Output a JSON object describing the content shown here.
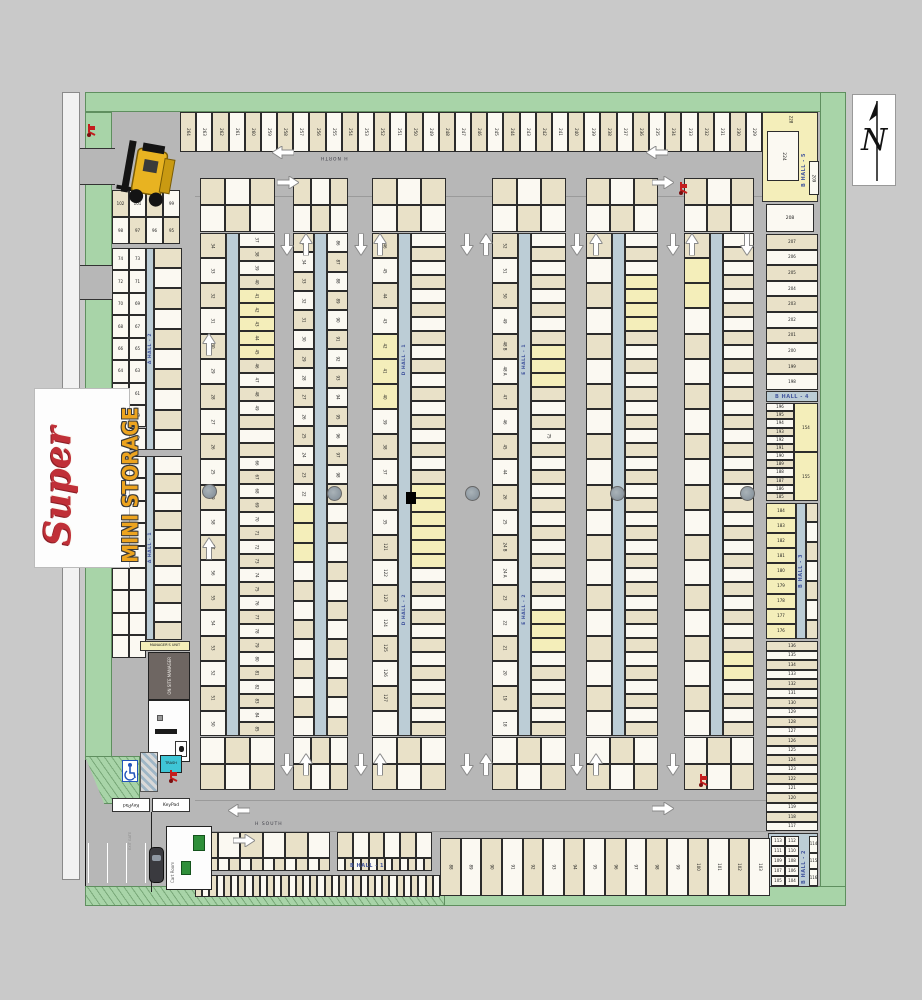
{
  "logo": {
    "super": "Super",
    "mini_storage": "MINI STORAGE"
  },
  "compass": {
    "letter": "N"
  },
  "roads": {
    "north": "H NORTH",
    "south": "H SOUTH"
  },
  "halls": {
    "a1": "A HALL - 1",
    "a2": "A HALL - 2",
    "b1": "B HALL - 1",
    "b2": "B HALL - 2",
    "b3": "B HALL - 3",
    "b4": "B HALL - 4",
    "b5": "B HALL - 5",
    "d1": "D HALL - 1",
    "d2": "D HALL - 2",
    "e1": "E HALL - 1",
    "e2": "E HALL - 2"
  },
  "top_row": {
    "units": [
      "264",
      "263",
      "262",
      "261",
      "260",
      "259",
      "258",
      "257",
      "256",
      "255",
      "254",
      "253",
      "252",
      "251",
      "250",
      "249",
      "248",
      "247",
      "246",
      "245",
      "244",
      "243",
      "242",
      "241",
      "240",
      "239",
      "238",
      "237",
      "236",
      "235",
      "234",
      "233",
      "232",
      "231",
      "230",
      "229"
    ]
  },
  "corner_ne": {
    "u228": "228",
    "u224": "224",
    "u209": "209"
  },
  "right_col": {
    "unit208": "208",
    "col": [
      "207",
      "206",
      "205",
      "204",
      "203",
      "202",
      "201",
      "200",
      "199",
      "198"
    ],
    "hall4_left": [
      "196",
      "195",
      "194",
      "193",
      "192",
      "191",
      "190",
      "189",
      "188",
      "187",
      "186",
      "185"
    ],
    "hall4_right": [
      "154",
      "155"
    ],
    "hall3_left": [
      "184",
      "183",
      "182",
      "181",
      "180",
      "179",
      "178",
      "177",
      "176"
    ],
    "hall3_right": [
      "",
      "",
      "",
      "",
      "",
      "",
      ""
    ],
    "lower": [
      "136",
      "135",
      "134",
      "133",
      "132",
      "131",
      "130",
      "129",
      "128",
      "127",
      "126",
      "125",
      "124",
      "123",
      "122",
      "121",
      "120",
      "119",
      "118",
      "117"
    ],
    "b2_grid": [
      "113",
      "112",
      "111",
      "110",
      "109",
      "108",
      "107",
      "106",
      "105",
      "104"
    ],
    "b2_side": [
      "114",
      "115",
      "116"
    ]
  },
  "left": {
    "cluster_row1": [
      "102",
      "101",
      "100",
      "99"
    ],
    "cluster_row2": [
      "98",
      "97",
      "96",
      "95"
    ],
    "a2_pairs": [
      "74",
      "73",
      "72",
      "71",
      "70",
      "69",
      "68",
      "67",
      "66",
      "65",
      "64",
      "63",
      "62",
      "61",
      "60",
      "59",
      "58",
      "57"
    ],
    "a2_large": [
      "",
      "",
      "",
      "",
      "",
      "",
      "",
      "",
      "",
      ""
    ],
    "a1_pairs": [
      "",
      "",
      "",
      "",
      "",
      "",
      "",
      "",
      "",
      "",
      "",
      "",
      "",
      "",
      "",
      "",
      "",
      ""
    ],
    "a1_large": [
      "",
      "",
      "",
      "",
      "",
      "",
      "",
      "",
      "",
      ""
    ]
  },
  "strips": {
    "s1": {
      "top": [
        "",
        "",
        "",
        "",
        "",
        ""
      ],
      "bottom": [
        "",
        "",
        "",
        "",
        "",
        ""
      ],
      "left": [
        "34",
        "33",
        "32",
        "31",
        "30",
        "29",
        "28",
        "27",
        "26",
        "25",
        "59",
        "58",
        "57",
        "56",
        "55",
        "54",
        "53",
        "52",
        "51",
        "50"
      ],
      "right": [
        "37",
        "38",
        "39",
        "40",
        "41",
        "42",
        "43",
        "44",
        "45",
        "46",
        "47",
        "48",
        "49",
        "",
        "",
        "",
        "66",
        "67",
        "68",
        "69",
        "70",
        "71",
        "72",
        "73",
        "74",
        "75",
        "76",
        "77",
        "78",
        "79",
        "80",
        "81",
        "82",
        "83",
        "84",
        "85"
      ],
      "right_yellow": [
        4,
        5,
        6,
        7,
        8
      ]
    },
    "s2": {
      "top": [
        "",
        "",
        "",
        "",
        "",
        ""
      ],
      "bottom": [
        "",
        "",
        "",
        "",
        "",
        ""
      ],
      "left": [
        "35",
        "34",
        "33",
        "32",
        "31",
        "30",
        "29",
        "28",
        "27",
        "26",
        "25",
        "24",
        "23",
        "22",
        "",
        "",
        "",
        "",
        "",
        "",
        "",
        "",
        "",
        "",
        "",
        ""
      ],
      "right": [
        "86",
        "87",
        "88",
        "89",
        "90",
        "91",
        "92",
        "93",
        "94",
        "95",
        "96",
        "97",
        "98",
        "99",
        "",
        "",
        "",
        "",
        "",
        "",
        "",
        "",
        "",
        "",
        "",
        ""
      ],
      "left_yellow": [
        14,
        15,
        16
      ]
    },
    "s3": {
      "top": [
        "",
        "",
        "",
        "",
        "",
        ""
      ],
      "bottom": [
        "",
        "",
        "",
        "",
        "",
        ""
      ],
      "left": [
        "46",
        "45",
        "44",
        "43",
        "42",
        "41",
        "40",
        "39",
        "38",
        "37",
        "36",
        "35",
        "121",
        "122",
        "123",
        "124",
        "125",
        "126",
        "127",
        ""
      ],
      "left_yellow": [
        4,
        5,
        6
      ],
      "right": [
        "",
        "",
        "",
        "",
        "",
        "",
        "",
        "",
        "",
        "",
        "",
        "",
        "",
        "",
        "",
        "",
        "",
        "",
        "",
        "",
        "",
        "",
        "",
        "",
        "",
        "",
        "",
        "",
        "",
        "",
        "",
        "",
        "",
        "",
        "",
        ""
      ],
      "right_yellow": [
        18,
        19,
        20,
        21,
        22,
        23
      ]
    },
    "s4": {
      "top": [
        "",
        "",
        "",
        "",
        "",
        ""
      ],
      "bottom": [
        "",
        "",
        "",
        "",
        "",
        ""
      ],
      "left": [
        "52",
        "51",
        "50",
        "49",
        "48 B",
        "48 A",
        "47",
        "46",
        "45",
        "44",
        "26",
        "25",
        "24 B",
        "24 A",
        "23",
        "22",
        "21",
        "20",
        "19",
        "18"
      ],
      "right": [
        "",
        "",
        "",
        "",
        "",
        "",
        "",
        "",
        "",
        "",
        "",
        "",
        "",
        "",
        "75",
        "",
        "",
        "",
        "",
        "",
        "",
        "",
        "",
        "",
        "",
        "",
        "",
        "",
        "",
        "",
        "",
        "",
        "",
        "",
        "",
        ""
      ],
      "right_yellow": [
        8,
        9,
        10,
        27,
        28,
        29
      ]
    },
    "s5": {
      "top": [
        "",
        "",
        "",
        "",
        "",
        ""
      ],
      "bottom": [
        "",
        "",
        "",
        "",
        "",
        ""
      ],
      "left": [
        "",
        "",
        "",
        "",
        "",
        "",
        "",
        "",
        "",
        "",
        "",
        "",
        "",
        "",
        "",
        "",
        "",
        "",
        "",
        ""
      ],
      "right": [
        "",
        "",
        "",
        "",
        "",
        "",
        "",
        "",
        "",
        "",
        "",
        "",
        "",
        "",
        "",
        "",
        "",
        "",
        "",
        "",
        "",
        "",
        "",
        "",
        "",
        "",
        "",
        "",
        "",
        "",
        "",
        "",
        "",
        "",
        "",
        ""
      ],
      "right_yellow": [
        3,
        4,
        5,
        6
      ]
    },
    "s6": {
      "top": [
        "",
        "",
        "",
        "",
        "",
        ""
      ],
      "bottom": [
        "",
        "",
        "",
        "",
        "",
        ""
      ],
      "left": [
        "",
        "",
        "",
        "",
        "",
        "",
        "",
        "",
        "",
        "",
        "",
        "",
        "",
        "",
        "",
        "",
        "",
        "",
        "",
        ""
      ],
      "left_yellow": [
        1,
        2
      ],
      "right": [
        "",
        "",
        "",
        "",
        "",
        "",
        "",
        "",
        "",
        "",
        "",
        "",
        "",
        "",
        "",
        "",
        "",
        "",
        "",
        "",
        "",
        "",
        "",
        "",
        "",
        "",
        "",
        "",
        "",
        "",
        "",
        "",
        "",
        "",
        "",
        ""
      ],
      "right_yellow": [
        30,
        31
      ]
    }
  },
  "bottom": {
    "a1_large": [
      "",
      "",
      "",
      "",
      "",
      ""
    ],
    "a1_small": [
      "",
      "",
      "",
      "",
      "",
      "",
      "",
      "",
      "",
      "",
      "",
      ""
    ],
    "a2_large": [
      "",
      "",
      "",
      "",
      "",
      ""
    ],
    "a2_small": [
      "",
      "",
      "",
      "",
      "",
      "",
      "",
      "",
      "",
      "",
      "",
      ""
    ],
    "row": [
      "",
      "",
      "",
      "",
      "",
      "",
      "",
      "",
      "",
      "",
      "",
      "",
      "",
      "",
      "",
      "",
      "",
      "",
      "",
      "",
      "",
      "",
      "",
      "",
      "",
      "",
      "",
      "",
      "",
      "",
      "",
      "",
      "",
      ""
    ],
    "b_large": [
      "88",
      "89",
      "90",
      "91",
      "92",
      "93",
      "94",
      "95",
      "96",
      "97",
      "98",
      "99",
      "100",
      "101",
      "102",
      "103"
    ]
  },
  "office": {
    "managers_unit": "MANAGER'S UNIT",
    "on_site_manager": "ON SITE MANAGER",
    "trash": "TRASH",
    "keypad_exit": "KeyPad",
    "keypad_enter": "KeyPad",
    "cart_room": "Cart Room",
    "exit_gate": "EXIT GATE"
  },
  "arrows": [
    {
      "x": 272,
      "y": 148,
      "d": "left"
    },
    {
      "x": 277,
      "y": 174,
      "d": "right"
    },
    {
      "x": 646,
      "y": 148,
      "d": "left"
    },
    {
      "x": 652,
      "y": 174,
      "d": "right"
    },
    {
      "x": 278,
      "y": 238,
      "d": "down"
    },
    {
      "x": 293,
      "y": 238,
      "d": "up"
    },
    {
      "x": 352,
      "y": 238,
      "d": "down"
    },
    {
      "x": 367,
      "y": 238,
      "d": "up"
    },
    {
      "x": 458,
      "y": 238,
      "d": "down"
    },
    {
      "x": 473,
      "y": 238,
      "d": "up"
    },
    {
      "x": 568,
      "y": 238,
      "d": "down"
    },
    {
      "x": 583,
      "y": 238,
      "d": "up"
    },
    {
      "x": 664,
      "y": 238,
      "d": "down"
    },
    {
      "x": 679,
      "y": 238,
      "d": "up"
    },
    {
      "x": 738,
      "y": 238,
      "d": "down"
    },
    {
      "x": 196,
      "y": 338,
      "d": "up"
    },
    {
      "x": 196,
      "y": 542,
      "d": "up"
    },
    {
      "x": 278,
      "y": 758,
      "d": "down"
    },
    {
      "x": 293,
      "y": 758,
      "d": "up"
    },
    {
      "x": 352,
      "y": 758,
      "d": "down"
    },
    {
      "x": 367,
      "y": 758,
      "d": "up"
    },
    {
      "x": 458,
      "y": 758,
      "d": "down"
    },
    {
      "x": 473,
      "y": 758,
      "d": "up"
    },
    {
      "x": 568,
      "y": 758,
      "d": "down"
    },
    {
      "x": 583,
      "y": 758,
      "d": "up"
    },
    {
      "x": 664,
      "y": 758,
      "d": "down"
    },
    {
      "x": 228,
      "y": 806,
      "d": "left"
    },
    {
      "x": 233,
      "y": 832,
      "d": "right"
    },
    {
      "x": 652,
      "y": 800,
      "d": "right"
    }
  ],
  "drains": [
    {
      "x": 202,
      "y": 484
    },
    {
      "x": 327,
      "y": 486
    },
    {
      "x": 465,
      "y": 486
    },
    {
      "x": 610,
      "y": 486
    },
    {
      "x": 740,
      "y": 486
    }
  ],
  "red_carts": [
    {
      "x": 86,
      "y": 122
    },
    {
      "x": 678,
      "y": 180
    },
    {
      "x": 698,
      "y": 772
    },
    {
      "x": 168,
      "y": 768
    }
  ],
  "colors": {
    "green": "#a8d4a8",
    "road": "#b7b7b7",
    "unit_tan": "#e9e1c8",
    "unit_white": "#fbf9f2",
    "highlight": "#f4eeba",
    "hall_text": "#44579e",
    "logo_red": "#c03038",
    "logo_orange": "#eda41f",
    "trash": "#3fc6d6"
  }
}
